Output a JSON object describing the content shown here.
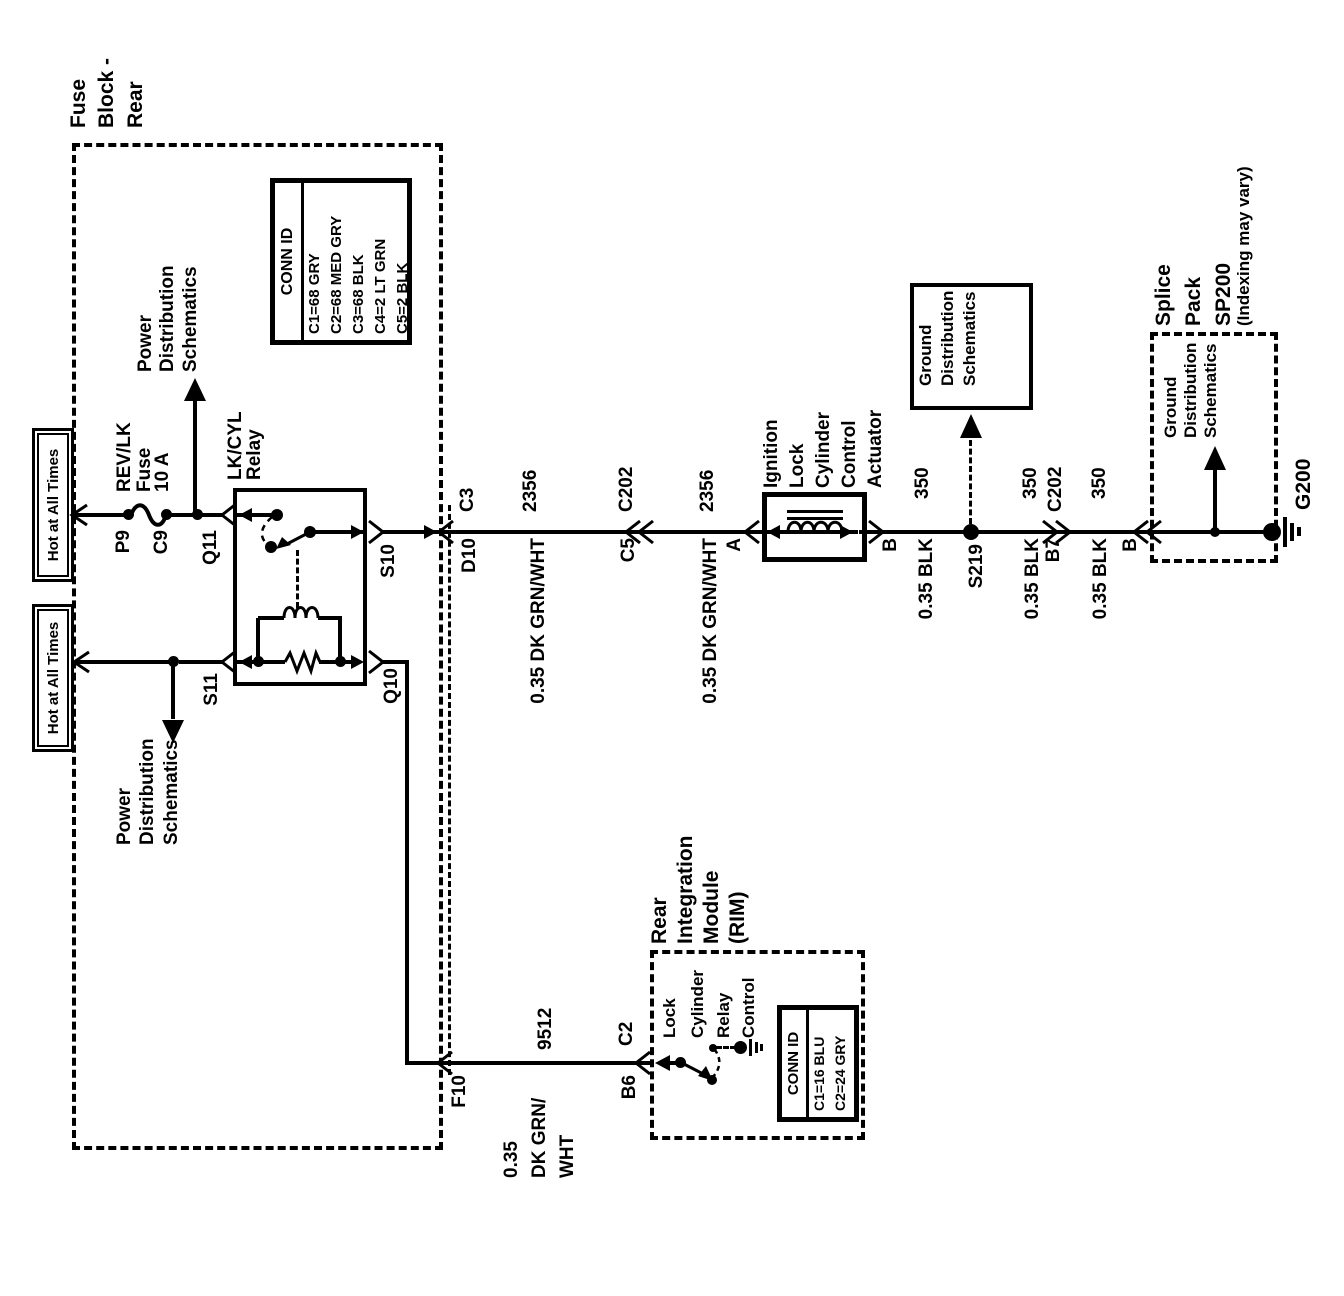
{
  "feeds": {
    "hot1": "Hot at All Times",
    "hot2": "Hot at All Times",
    "power_dist1": [
      "Power",
      "Distribution",
      "Schematics"
    ],
    "power_dist2": [
      "Power",
      "Distribution",
      "Schematics"
    ]
  },
  "fuse_block": {
    "title": [
      "Fuse",
      "Block -",
      "Rear"
    ],
    "fuse": [
      "REV/LK",
      "Fuse",
      "10 A"
    ],
    "conn_id": {
      "header": "CONN ID",
      "rows": [
        "C1=68 GRY",
        "C2=68 MED GRY",
        "C3=68 BLK",
        "C4=2 LT GRN",
        "C5=2 BLK"
      ]
    },
    "pins": {
      "p9": "P9",
      "c9": "C9",
      "q11": "Q11",
      "s11": "S11",
      "s10": "S10",
      "q10": "Q10",
      "f10": "F10",
      "d10": "D10",
      "c3": "C3"
    }
  },
  "relay": {
    "title": [
      "LK/CYL",
      "Relay"
    ]
  },
  "wires": {
    "grnwht1": {
      "circuit": "2356",
      "name": "0.35 DK GRN/WHT"
    },
    "grnwht2": {
      "circuit": "2356",
      "name": "0.35 DK GRN/WHT"
    },
    "rim_wire": {
      "circuit": "9512",
      "name": [
        "0.35",
        "DK GRN/",
        "WHT"
      ]
    },
    "blk1": {
      "circuit": "350",
      "name": "0.35 BLK"
    },
    "blk2": {
      "circuit": "350",
      "name": "0.35 BLK"
    },
    "blk3": {
      "circuit": "350",
      "name": "0.35 BLK"
    }
  },
  "connectors": {
    "c202a": "C202",
    "c5": "C5",
    "c202b": "C202",
    "b7": "B7",
    "c2": "C2",
    "b6": "B6"
  },
  "actuator": {
    "title": [
      "Ignition",
      "Lock",
      "Cylinder",
      "Control",
      "Actuator"
    ],
    "pin_a": "A",
    "pin_b": "B"
  },
  "grounds": {
    "gdist_box": [
      "Ground",
      "Distribution",
      "Schematics"
    ],
    "s219": "S219",
    "splice": {
      "title": [
        "Splice",
        "Pack",
        "SP200"
      ],
      "note": "(Indexing may vary)",
      "gdist": [
        "Ground",
        "Distribution",
        "Schematics"
      ],
      "pin_b": "B",
      "g200": "G200"
    }
  },
  "rim": {
    "title": [
      "Rear",
      "Integration",
      "Module",
      "(RIM)"
    ],
    "signal": [
      "Lock",
      "Cylinder",
      "Relay",
      "Control"
    ],
    "conn_id": {
      "header": "CONN ID",
      "rows": [
        "C1=16 BLU",
        "C2=24 GRY"
      ]
    }
  }
}
